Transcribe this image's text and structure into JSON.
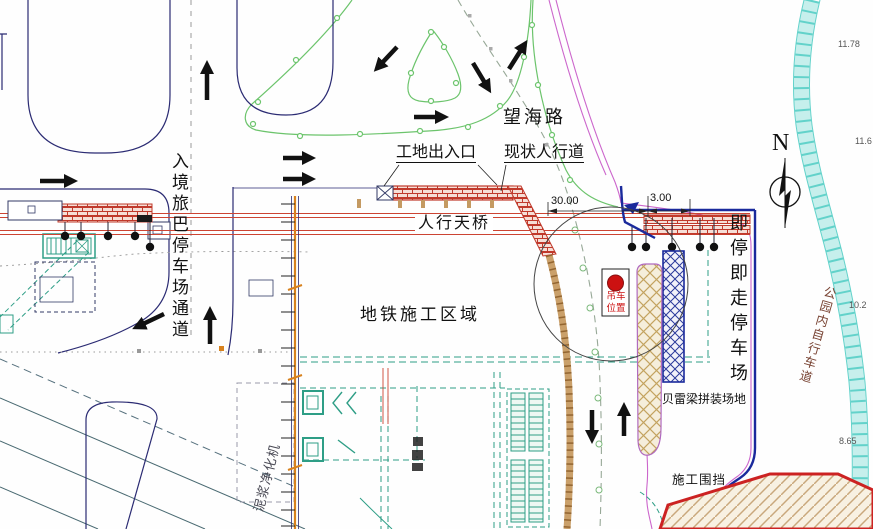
{
  "labels": {
    "road_name": "望海路",
    "site_gate": "工地出入口",
    "sidewalk": "现状人行道",
    "footbridge": "人行天桥",
    "metro_area": "地铁施工区域",
    "bus_channel": "入境旅巴停车场通道",
    "kiss_ride_parking": "即停即走停车场",
    "bailey_yard": "贝雷梁拼装场地",
    "fence": "施工围挡",
    "crane_l1": "吊车",
    "crane_l2": "位置",
    "bike_lane": "公园内自行车道",
    "mud_machine": "泥浆净化机",
    "north": "N"
  },
  "dimensions": {
    "span_main": "30.00",
    "span_side": "3.00"
  },
  "elevations": [
    "11.78",
    "11.6",
    "10.2",
    "8.65"
  ],
  "colors": {
    "bridge_red": "#c0392b",
    "boundary_blue": "#1a2a9c",
    "fence_orange": "#d8821e",
    "structure_teal": "#2e9e86",
    "bike_cyan": "#62d2ca",
    "magenta": "#cc66cc",
    "crane_dot_red": "#cc1111"
  }
}
